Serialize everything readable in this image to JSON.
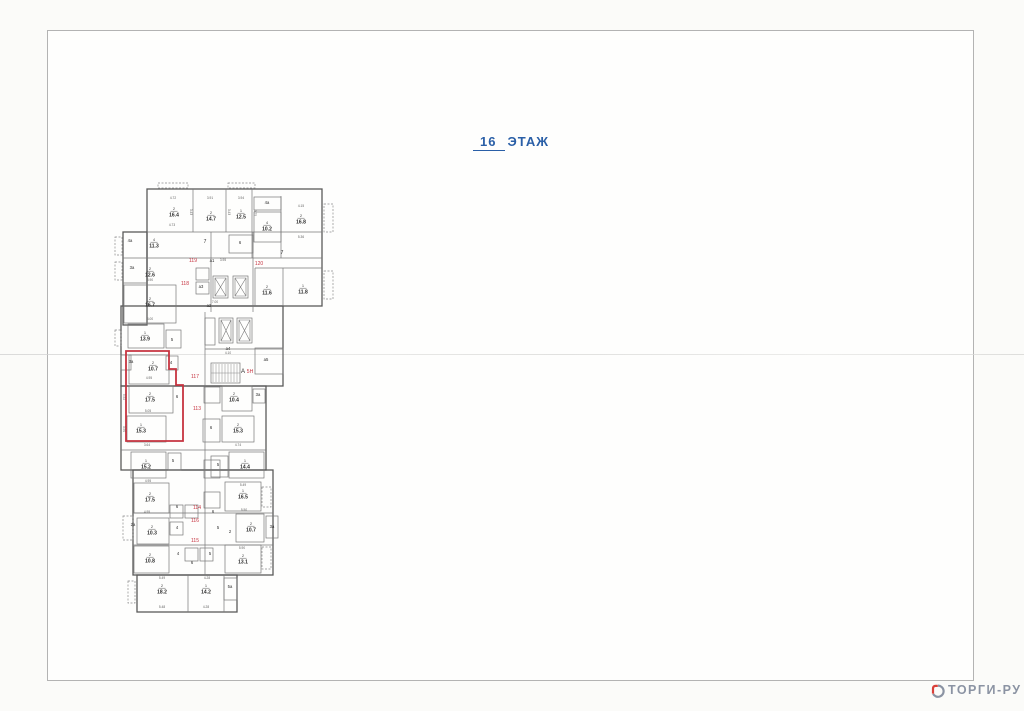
{
  "page": {
    "floor_number": "16",
    "floor_word": "ЭТАЖ"
  },
  "watermark": {
    "text": "ТОРГИ-РУ"
  },
  "colors": {
    "title_blue": "#2a5fa7",
    "plan_line": "#5a5a5a",
    "plan_line_light": "#787878",
    "red": "#c63440",
    "dim_gray": "#5f5f5f",
    "label_black": "#2c2c2c",
    "watermark_gray": "#8b93a3",
    "watermark_red": "#d9403a",
    "frame_gray": "#b3b3b3"
  },
  "plan": {
    "rooms": [
      {
        "num": "2",
        "area": "16.4",
        "x": 174,
        "y": 212
      },
      {
        "num": "2",
        "area": "14.7",
        "x": 211,
        "y": 216
      },
      {
        "num": "1",
        "area": "12.5",
        "x": 241,
        "y": 214
      },
      {
        "num": "4",
        "area": "10.2",
        "x": 267,
        "y": 226
      },
      {
        "num": "2",
        "area": "16.8",
        "x": 301,
        "y": 219
      },
      {
        "num": "4",
        "area": "11.3",
        "x": 154,
        "y": 243
      },
      {
        "num": "2",
        "area": "12.6",
        "x": 150,
        "y": 272
      },
      {
        "num": "2",
        "area": "16.7",
        "x": 150,
        "y": 302
      },
      {
        "num": "2",
        "area": "11.6",
        "x": 267,
        "y": 290
      },
      {
        "num": "1",
        "area": "11.8",
        "x": 303,
        "y": 289
      },
      {
        "num": "1",
        "area": "13.9",
        "x": 145,
        "y": 336
      },
      {
        "num": "2",
        "area": "10.7",
        "x": 153,
        "y": 366
      },
      {
        "num": "2",
        "area": "17.5",
        "x": 150,
        "y": 397
      },
      {
        "num": "1",
        "area": "15.3",
        "x": 141,
        "y": 428
      },
      {
        "num": "2",
        "area": "10.4",
        "x": 234,
        "y": 397
      },
      {
        "num": "2",
        "area": "15.3",
        "x": 238,
        "y": 428
      },
      {
        "num": "1",
        "area": "15.2",
        "x": 146,
        "y": 464
      },
      {
        "num": "1",
        "area": "14.4",
        "x": 245,
        "y": 464
      },
      {
        "num": "2",
        "area": "17.5",
        "x": 150,
        "y": 497
      },
      {
        "num": "1",
        "area": "16.5",
        "x": 243,
        "y": 494
      },
      {
        "num": "2",
        "area": "10.3",
        "x": 152,
        "y": 530
      },
      {
        "num": "2",
        "area": "10.7",
        "x": 251,
        "y": 527
      },
      {
        "num": "2",
        "area": "10.8",
        "x": 150,
        "y": 558
      },
      {
        "num": "2",
        "area": "13.1",
        "x": 243,
        "y": 559
      },
      {
        "num": "2",
        "area": "18.2",
        "x": 162,
        "y": 589
      },
      {
        "num": "1",
        "area": "14.2",
        "x": 206,
        "y": 589
      }
    ],
    "small_labels": [
      {
        "t": "4а",
        "x": 130,
        "y": 242
      },
      {
        "t": "3а",
        "x": 132,
        "y": 269
      },
      {
        "t": "4а",
        "x": 267,
        "y": 204
      },
      {
        "t": "7",
        "x": 205,
        "y": 243,
        "s": 5
      },
      {
        "t": "7",
        "x": 282,
        "y": 254,
        "s": 5
      },
      {
        "t": "6",
        "x": 240,
        "y": 244
      },
      {
        "t": "а1",
        "x": 212,
        "y": 262
      },
      {
        "t": "а3",
        "x": 201,
        "y": 288
      },
      {
        "t": "а2",
        "x": 209,
        "y": 307
      },
      {
        "t": "а4",
        "x": 228,
        "y": 350
      },
      {
        "t": "а5",
        "x": 266,
        "y": 361
      },
      {
        "t": "А",
        "x": 243,
        "y": 373,
        "s": 6
      },
      {
        "t": "5",
        "x": 172,
        "y": 341
      },
      {
        "t": "4",
        "x": 171,
        "y": 364
      },
      {
        "t": "6",
        "x": 177,
        "y": 398
      },
      {
        "t": "3а",
        "x": 131,
        "y": 363
      },
      {
        "t": "3а",
        "x": 258,
        "y": 396
      },
      {
        "t": "6",
        "x": 211,
        "y": 429
      },
      {
        "t": "5",
        "x": 173,
        "y": 462
      },
      {
        "t": "5",
        "x": 218,
        "y": 466
      },
      {
        "t": "6",
        "x": 177,
        "y": 508
      },
      {
        "t": "6",
        "x": 213,
        "y": 513
      },
      {
        "t": "4",
        "x": 177,
        "y": 529
      },
      {
        "t": "5",
        "x": 218,
        "y": 529
      },
      {
        "t": "2",
        "x": 230,
        "y": 533
      },
      {
        "t": "4",
        "x": 178,
        "y": 555
      },
      {
        "t": "5",
        "x": 210,
        "y": 555
      },
      {
        "t": "6",
        "x": 192,
        "y": 564
      },
      {
        "t": "2а",
        "x": 133,
        "y": 526
      },
      {
        "t": "3а",
        "x": 272,
        "y": 528
      },
      {
        "t": "5а",
        "x": 230,
        "y": 588
      }
    ],
    "red_labels": [
      {
        "t": "119",
        "x": 193,
        "y": 262
      },
      {
        "t": "120",
        "x": 259,
        "y": 265
      },
      {
        "t": "118",
        "x": 185,
        "y": 285
      },
      {
        "t": "117",
        "x": 195,
        "y": 378
      },
      {
        "t": "113",
        "x": 197,
        "y": 410
      },
      {
        "t": "5Н",
        "x": 250,
        "y": 373
      },
      {
        "t": "114",
        "x": 197,
        "y": 509
      },
      {
        "t": "116",
        "x": 195,
        "y": 522
      },
      {
        "t": "115",
        "x": 195,
        "y": 542
      }
    ],
    "dimensions": [
      {
        "t": "4.72",
        "x": 173,
        "y": 199
      },
      {
        "t": "3.91",
        "x": 210,
        "y": 199
      },
      {
        "t": "3.94",
        "x": 241,
        "y": 199
      },
      {
        "t": "4.73",
        "x": 172,
        "y": 226
      },
      {
        "t": "4.15",
        "x": 301,
        "y": 207
      },
      {
        "t": "5.36",
        "x": 301,
        "y": 238
      },
      {
        "t": "3.95",
        "x": 223,
        "y": 261
      },
      {
        "t": "7.00",
        "x": 215,
        "y": 303
      },
      {
        "t": "3.90",
        "x": 150,
        "y": 281
      },
      {
        "t": "4.00",
        "x": 150,
        "y": 320
      },
      {
        "t": "4.10",
        "x": 228,
        "y": 354
      },
      {
        "t": "4.95",
        "x": 149,
        "y": 379
      },
      {
        "t": "5.05",
        "x": 148,
        "y": 412
      },
      {
        "t": "3.64",
        "x": 147,
        "y": 446
      },
      {
        "t": "4.74",
        "x": 238,
        "y": 446
      },
      {
        "t": "5.49",
        "x": 243,
        "y": 486
      },
      {
        "t": "5.50",
        "x": 244,
        "y": 511
      },
      {
        "t": "5.90",
        "x": 242,
        "y": 549
      },
      {
        "t": "4.95",
        "x": 148,
        "y": 482
      },
      {
        "t": "4.95",
        "x": 147,
        "y": 513
      },
      {
        "t": "5.49",
        "x": 162,
        "y": 579
      },
      {
        "t": "4.28",
        "x": 207,
        "y": 579
      },
      {
        "t": "5.48",
        "x": 162,
        "y": 608
      },
      {
        "t": "4.28",
        "x": 206,
        "y": 608
      },
      {
        "t": "3.43",
        "x": 190,
        "y": 212,
        "r": 90
      },
      {
        "t": "3.43",
        "x": 228,
        "y": 212,
        "r": 90
      },
      {
        "t": "3.75",
        "x": 254,
        "y": 213,
        "r": 90
      },
      {
        "t": "5.52",
        "x": 123,
        "y": 397,
        "r": 90
      },
      {
        "t": "3.50",
        "x": 123,
        "y": 429,
        "r": 90
      }
    ],
    "red_outline_points": "126,351 169,351 169,369 176,369 176,385 183,385 183,441 126,441"
  }
}
